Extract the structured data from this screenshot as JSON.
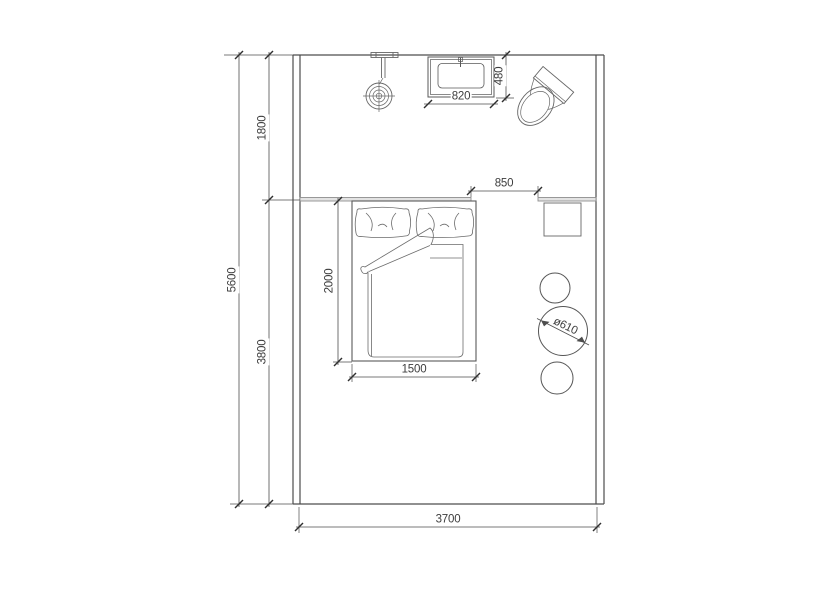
{
  "labels": {
    "total_depth": "5600",
    "bath_zone_depth": "1800",
    "bed_zone_depth": "3800",
    "room_width": "3700",
    "basin_width": "820",
    "basin_depth": "480",
    "opening_width": "850",
    "bed_length": "2000",
    "bed_width": "1500",
    "stool_diameter": "ø610"
  },
  "colors": {
    "wall_line": "#4d4d4d",
    "dim_line": "#4d4d4d",
    "furniture_line": "#6b6b6b",
    "partition_fill": "#e3e3e3",
    "text": "#3d3d3d"
  }
}
